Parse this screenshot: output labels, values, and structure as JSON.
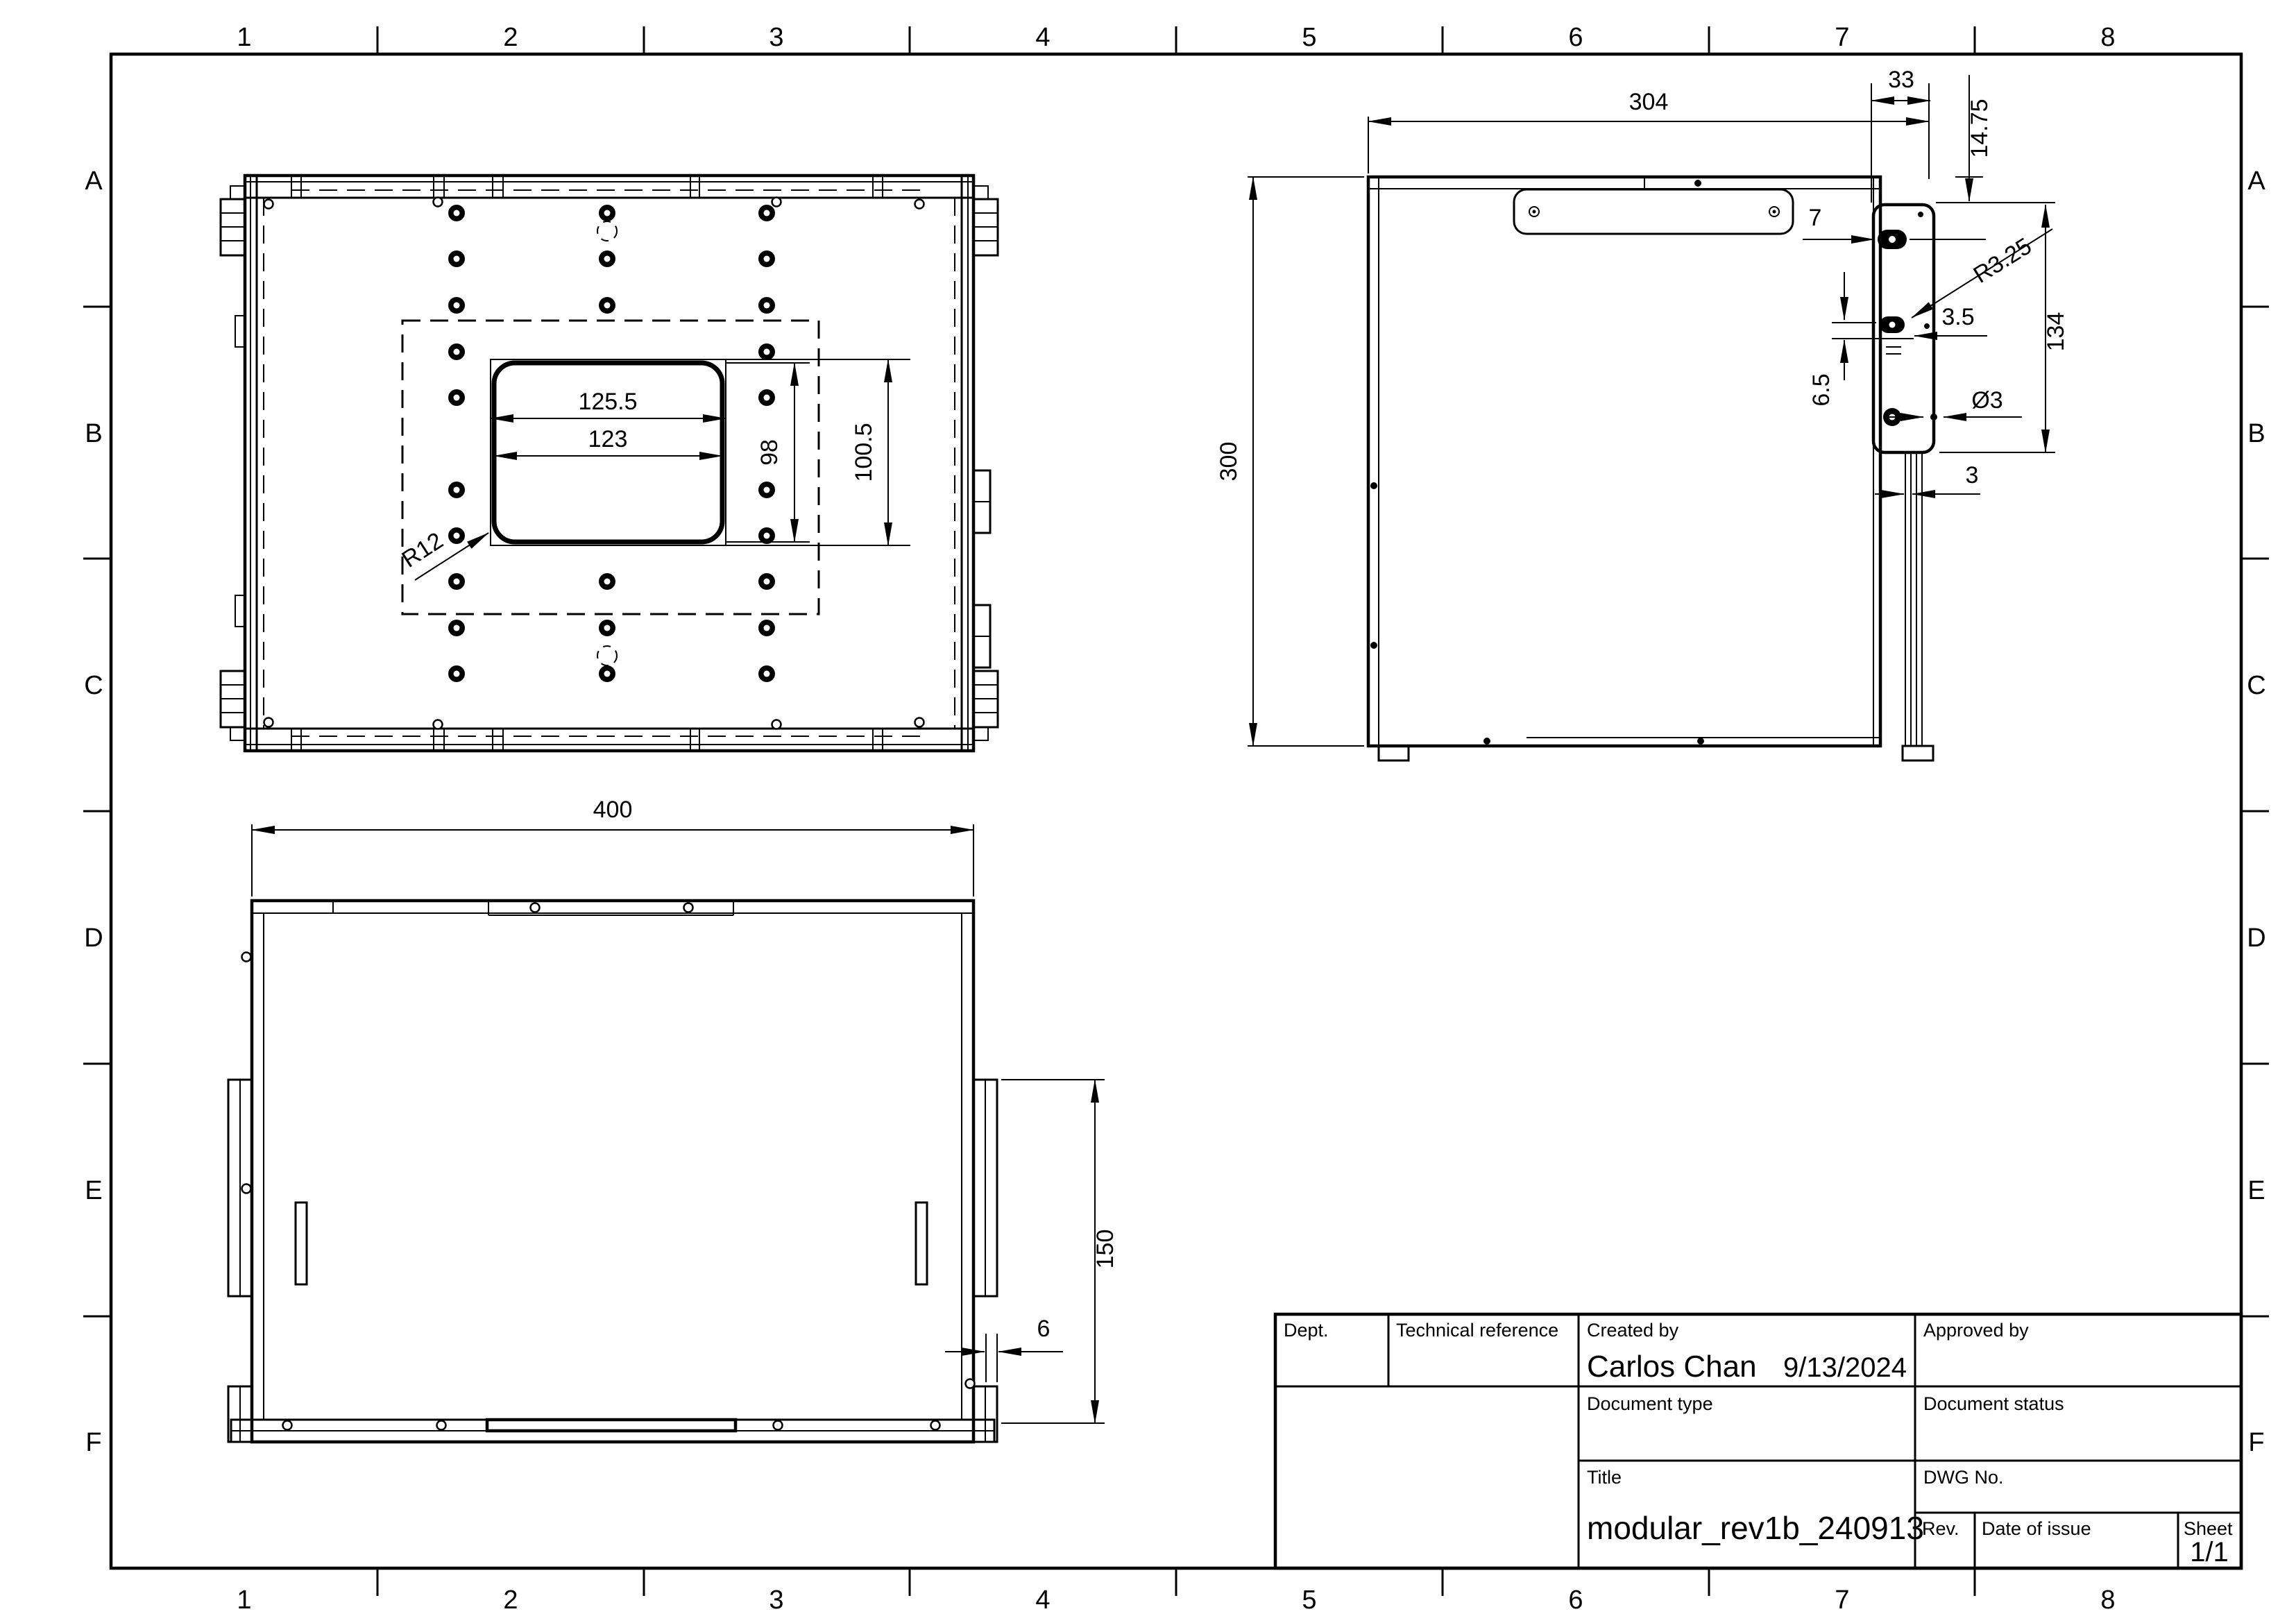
{
  "sheet": {
    "border": {
      "column_labels": [
        "1",
        "2",
        "3",
        "4",
        "5",
        "6",
        "7",
        "8"
      ],
      "row_labels": [
        "A",
        "B",
        "C",
        "D",
        "E",
        "F"
      ]
    },
    "title_block": {
      "dept_label": "Dept.",
      "technical_reference_label": "Technical reference",
      "created_by_label": "Created by",
      "created_by_value": "Carlos Chan",
      "created_date": "9/13/2024",
      "approved_by_label": "Approved by",
      "document_type_label": "Document type",
      "document_status_label": "Document status",
      "title_label": "Title",
      "title_value": "modular_rev1b_240913",
      "dwg_no_label": "DWG No.",
      "rev_label": "Rev.",
      "date_of_issue_label": "Date of issue",
      "sheet_label": "Sheet",
      "sheet_value": "1/1"
    },
    "views": {
      "top_view": {
        "dimensions": {
          "cutout_width_outer": "125.5",
          "cutout_width_inner": "123",
          "cutout_height_inner": "98",
          "cutout_height_outer": "100.5",
          "corner_radius": "R12"
        }
      },
      "side_view": {
        "dimensions": {
          "overall_width": "304",
          "overall_height": "300",
          "bracket_offset": "33",
          "top_offset": "14.75",
          "slot_offset": "7",
          "slot_radius": "R3.25",
          "hole_offset": "3.5",
          "hole_pitch": "6.5",
          "hole_diameter": "Ø3",
          "bracket_height": "134",
          "wall_thickness": "3"
        }
      },
      "front_view": {
        "dimensions": {
          "overall_width": "400",
          "flange_height": "150",
          "panel_thickness": "6"
        }
      }
    }
  }
}
